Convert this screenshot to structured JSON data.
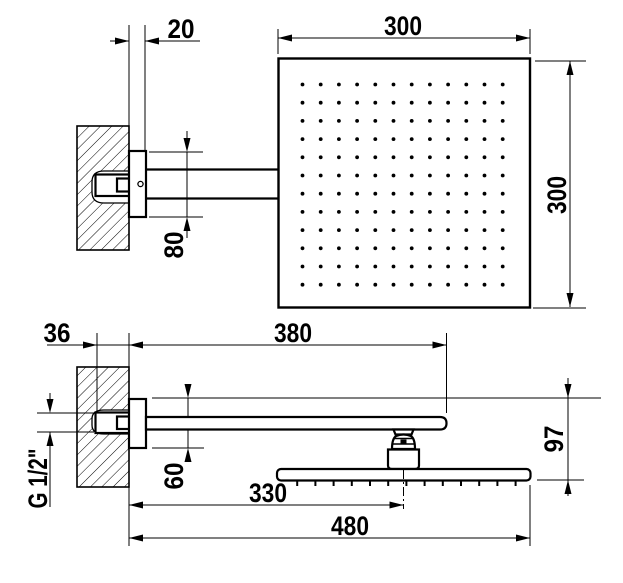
{
  "colors": {
    "line": "#000000",
    "background": "#ffffff"
  },
  "views": {
    "top": {
      "dim_wall_offset": "20",
      "dim_head_width": "300",
      "dim_head_height": "300",
      "dim_escutcheon_width": "80"
    },
    "side": {
      "dim_recess_depth": "36",
      "dim_arm_length": "380",
      "dim_escutcheon_height": "60",
      "dim_thread": "G 1/2\"",
      "dim_center_offset": "330",
      "dim_total_reach": "480",
      "dim_drop_height": "97"
    }
  },
  "nozzles": {
    "grid_rows": 12,
    "grid_cols": 12,
    "side_tick_count": 13
  }
}
